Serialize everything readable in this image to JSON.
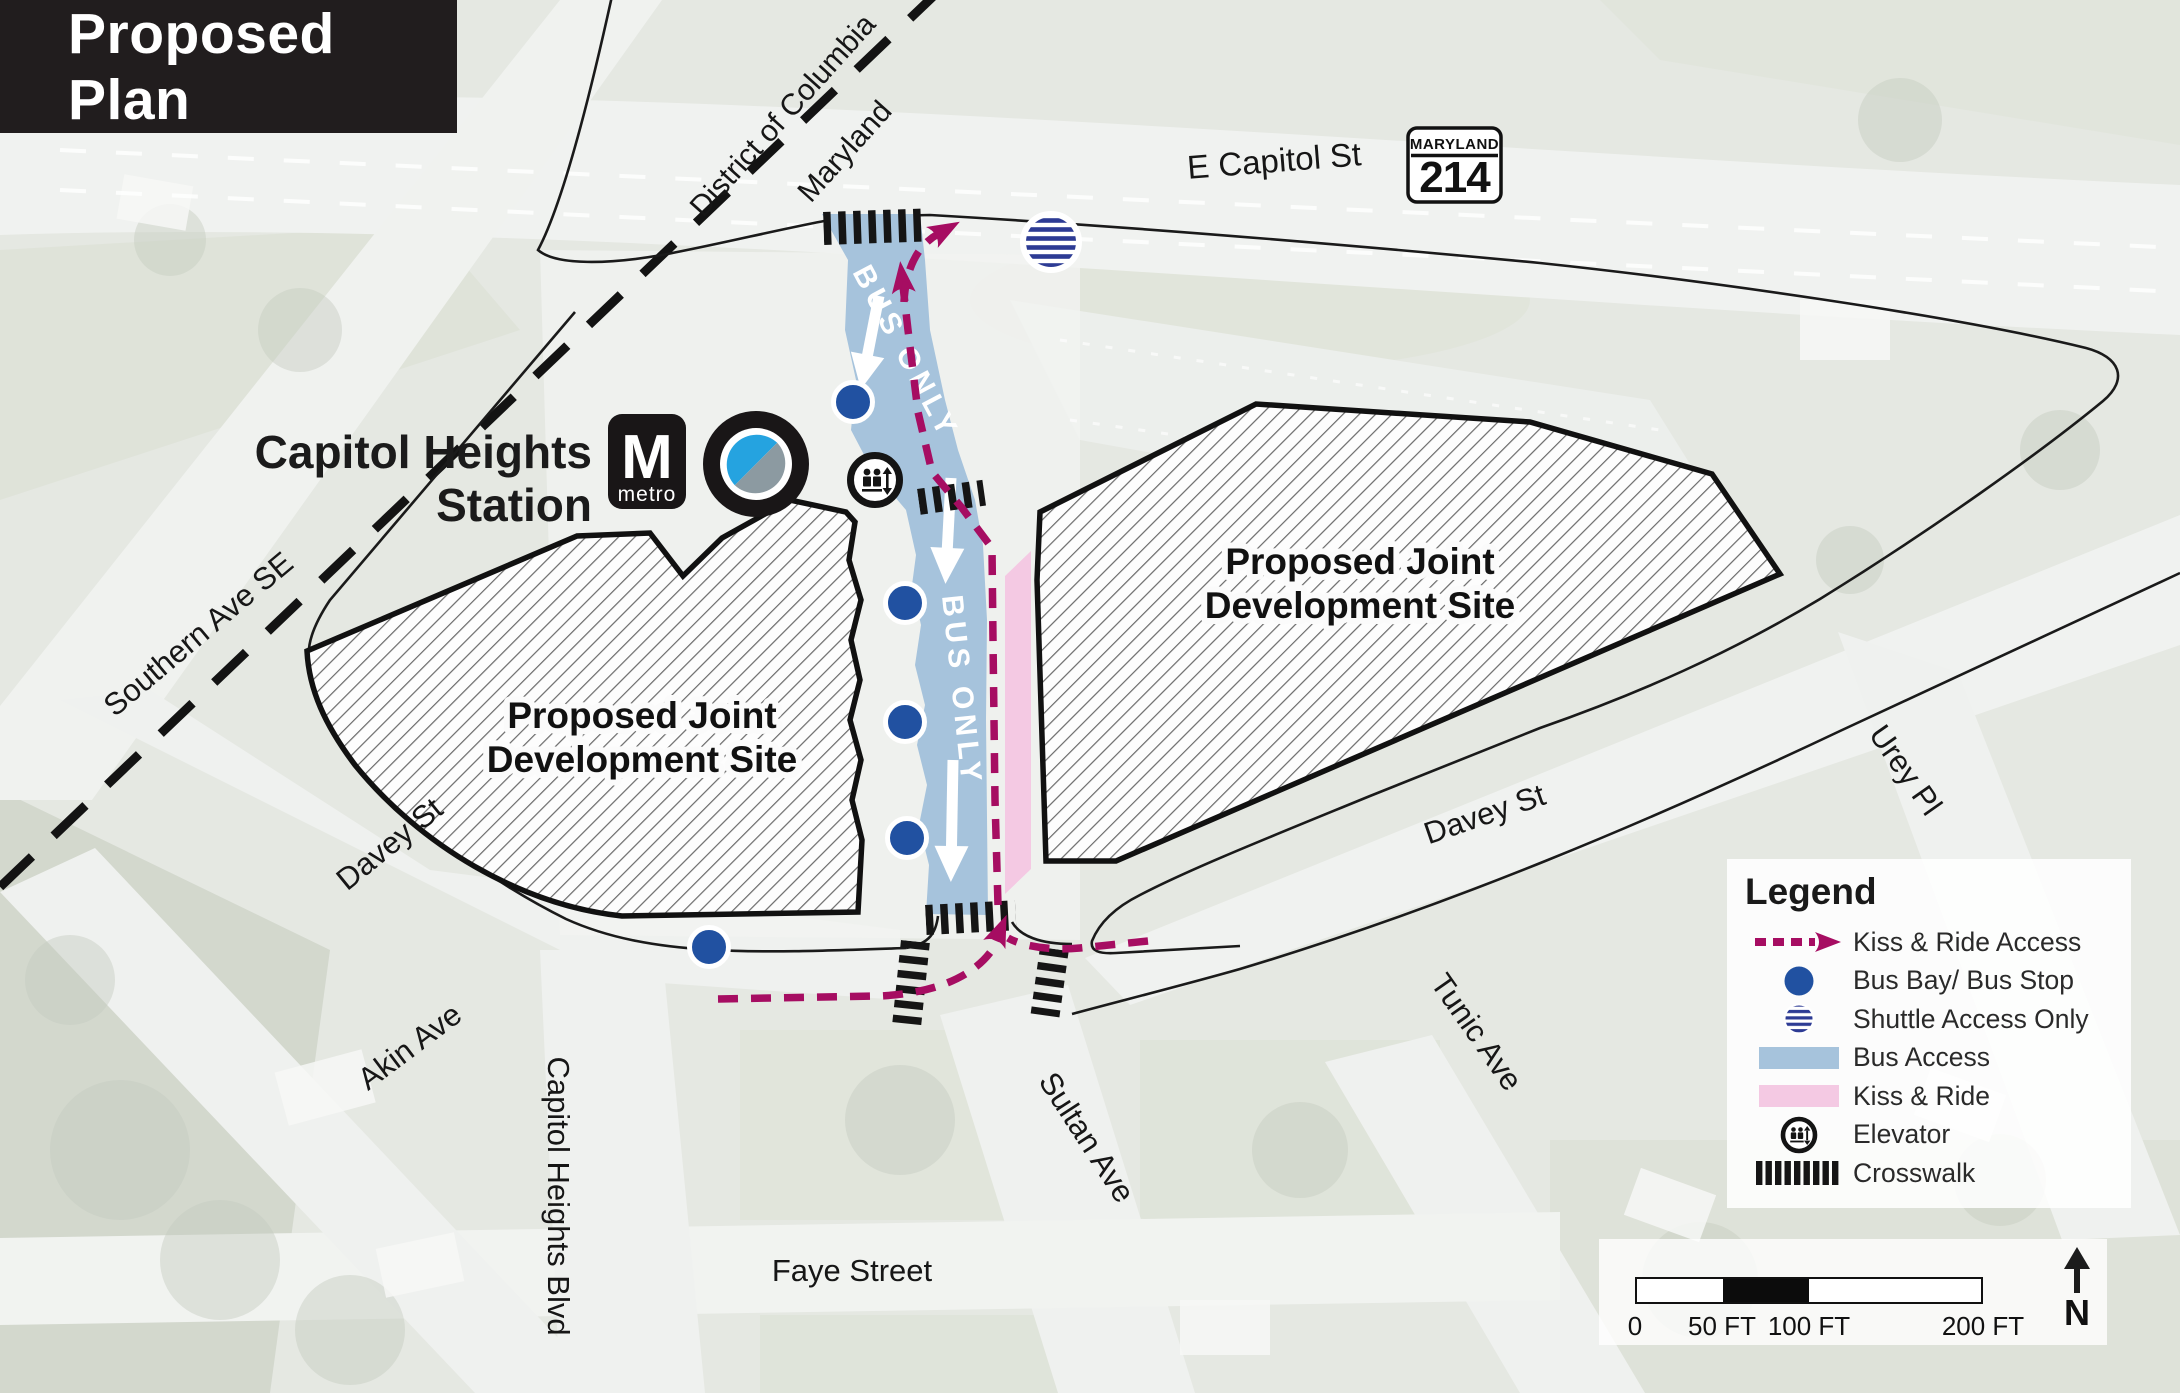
{
  "title": "Proposed Plan",
  "station": {
    "line1": "Capitol Heights",
    "line2": "Station",
    "metro_m": "M",
    "metro_word": "metro"
  },
  "boundary": {
    "dc": "District of Columbia",
    "md": "Maryland"
  },
  "shield": {
    "state": "MARYLAND",
    "number": "214"
  },
  "labels": {
    "e_capitol": "E Capitol St",
    "southern": "Southern Ave SE",
    "davey_west": "Davey St",
    "davey_east": "Davey St",
    "akin": "Akin Ave",
    "capitol_heights_blvd": "Capitol Heights Blvd",
    "faye": "Faye Street",
    "sultan": "Sultan Ave",
    "tunic": "Tunic Ave",
    "urey": "Urey Pl",
    "bus_only": "BUS ONLY",
    "site_line1": "Proposed Joint",
    "site_line2": "Development Site"
  },
  "legend": {
    "title": "Legend",
    "items": [
      {
        "icon": "kiss-ride-access-arrow-icon",
        "label": "Kiss & Ride Access"
      },
      {
        "icon": "bus-bay-dot-icon",
        "label": "Bus Bay/ Bus Stop"
      },
      {
        "icon": "shuttle-striped-dot-icon",
        "label": "Shuttle Access Only"
      },
      {
        "icon": "bus-access-swatch-icon",
        "label": "Bus Access"
      },
      {
        "icon": "kiss-ride-swatch-icon",
        "label": "Kiss & Ride"
      },
      {
        "icon": "elevator-icon",
        "label": "Elevator"
      },
      {
        "icon": "crosswalk-icon",
        "label": "Crosswalk"
      }
    ]
  },
  "scalebar": {
    "ticks": [
      "0",
      "50 FT",
      "100 FT",
      "200 FT"
    ],
    "north_label": "N"
  },
  "colors": {
    "magenta": "#A60D62",
    "bus_blue": "#A6C3DC",
    "kiss_pink": "#F4C9E3",
    "dot_blue": "#2151A1",
    "shuttle_navy": "#2D3B94",
    "metro_logo_blue": "#25A3E0",
    "metro_logo_gray": "#8C9AA1",
    "banner_bg": "#211D1E"
  }
}
